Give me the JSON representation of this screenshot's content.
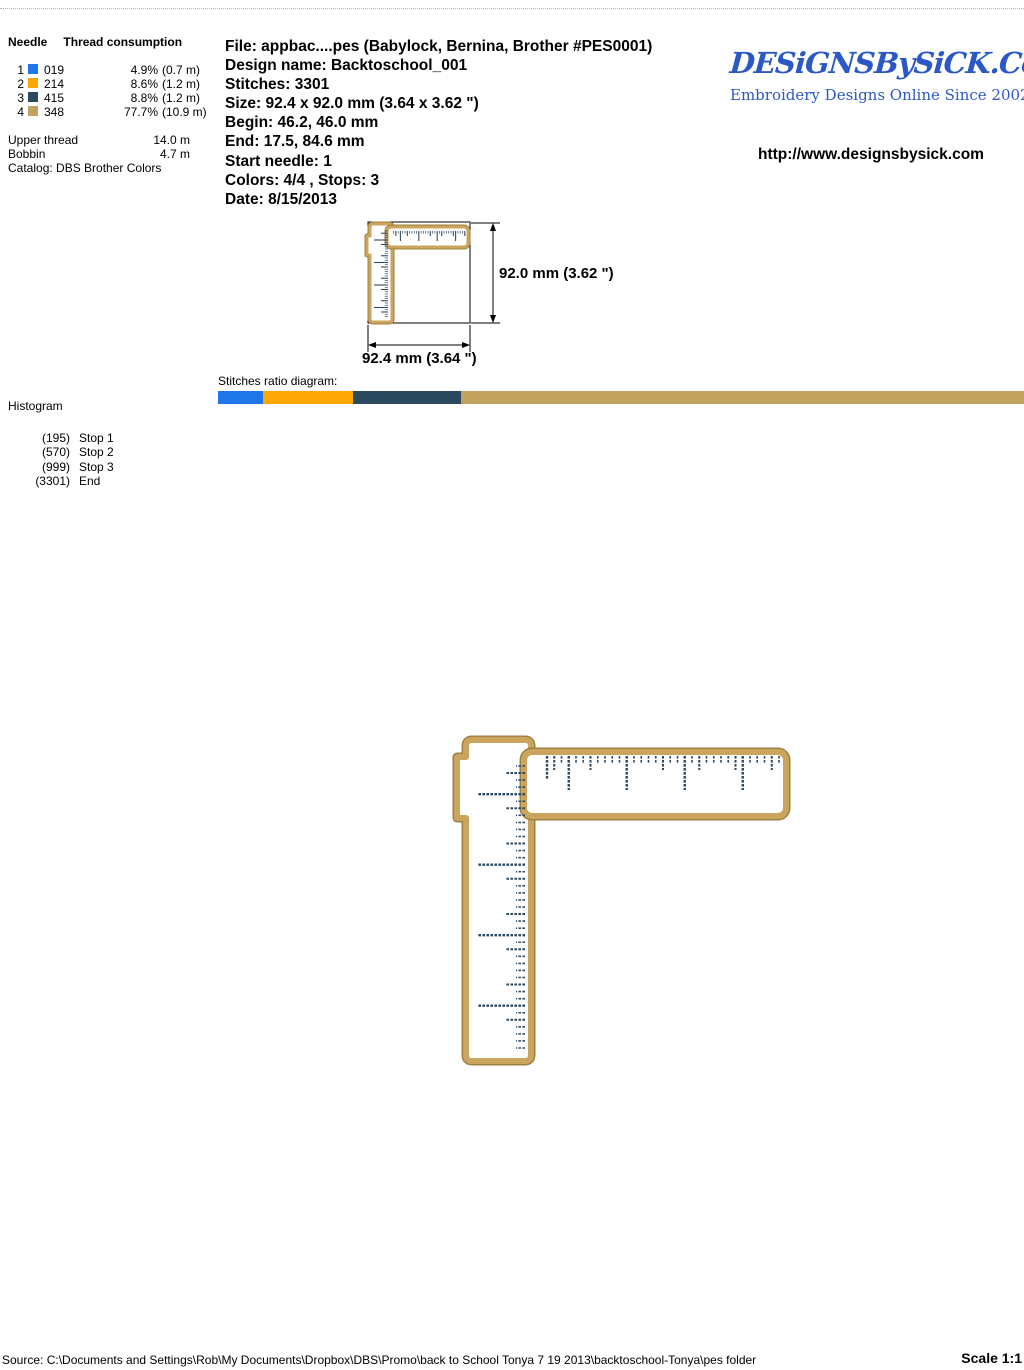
{
  "thread_table": {
    "header_needle": "Needle",
    "header_consumption": "Thread consumption",
    "rows": [
      {
        "needle": "1",
        "color": "#1E76E8",
        "code": "019",
        "percent": "4.9%",
        "length": "(0.7 m)"
      },
      {
        "needle": "2",
        "color": "#FFA805",
        "code": "214",
        "percent": "8.6%",
        "length": "(1.2 m)"
      },
      {
        "needle": "3",
        "color": "#2B4A60",
        "code": "415",
        "percent": "8.8%",
        "length": "(1.2 m)"
      },
      {
        "needle": "4",
        "color": "#C2A25F",
        "code": "348",
        "percent": "77.7%",
        "length": "(10.9 m)"
      }
    ],
    "upper_thread_label": "Upper thread",
    "upper_thread_value": "14.0 m",
    "bobbin_label": "Bobbin",
    "bobbin_value": "4.7 m",
    "catalog": "Catalog: DBS Brother Colors"
  },
  "file_info": {
    "file": "File: appbac....pes  (Babylock, Bernina, Brother #PES0001)",
    "design_name": "Design name: Backtoschool_001",
    "stitches": "Stitches: 3301",
    "size": "Size: 92.4 x 92.0 mm (3.64 x 3.62 \")",
    "begin": "Begin: 46.2, 46.0 mm",
    "end": "End: 17.5, 84.6 mm",
    "start_needle": "Start needle: 1",
    "colors": "Colors: 4/4 , Stops: 3",
    "date": "Date: 8/15/2013"
  },
  "branding": {
    "logo_text": "DESiGNSBySiCK.CoM",
    "tagline": "Embroidery Designs Online Since 2002",
    "url": "http://www.designsbysick.com",
    "logo_color": "#2B58C6"
  },
  "dimensions": {
    "height_label": "92.0 mm (3.62 \")",
    "width_label": "92.4 mm (3.64 \")"
  },
  "ratio": {
    "label": "Stitches ratio diagram:",
    "segments": [
      {
        "color": "#1E76E8",
        "width": "5.6%"
      },
      {
        "color": "#FFA805",
        "width": "11.2%"
      },
      {
        "color": "#2B4A60",
        "width": "13.3%"
      },
      {
        "color": "#C2A25F",
        "width": "69.9%"
      }
    ]
  },
  "histogram": {
    "label": "Histogram",
    "stops": [
      {
        "count": "(195)",
        "label": "Stop 1"
      },
      {
        "count": "(570)",
        "label": "Stop 2"
      },
      {
        "count": "(999)",
        "label": "Stop 3"
      },
      {
        "count": "(3301)",
        "label": "End"
      }
    ]
  },
  "design": {
    "border_fill": "#CBA55D",
    "border_edge": "#9E8140",
    "tick_color": "#2E4A60"
  },
  "footer": {
    "source": "Source: C:\\Documents and Settings\\Rob\\My Documents\\Dropbox\\DBS\\Promo\\back to School Tonya 7 19 2013\\backtoschool-Tonya\\pes folder",
    "scale": "Scale 1:1"
  }
}
